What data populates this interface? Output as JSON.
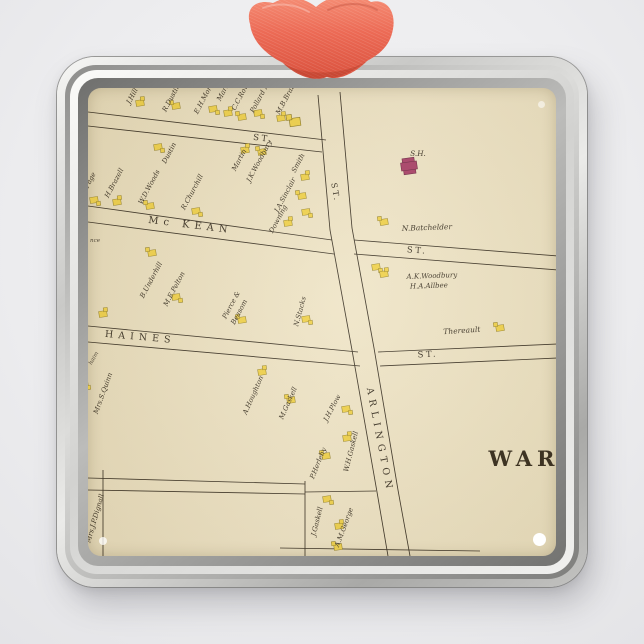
{
  "scene": {
    "description": "square silver metal photo ornament with coral ribbon showing antique street atlas map",
    "ribbon_color": "#ec6a55",
    "ribbon_highlight": "#f69078",
    "ribbon_shadow": "#d34e3a",
    "frame_silver_light": "#f0f0ee",
    "frame_silver_dark": "#8d8d8b",
    "map_background": "#ebe1c3",
    "map_ink": "#3a3226",
    "house_fill": "#f0d24d",
    "house_stroke": "#8d7b25",
    "school_fill": "#a84069"
  },
  "map": {
    "labels": [
      {
        "text": "ST.",
        "kind": "street",
        "x": 263,
        "y": 141,
        "rot": 7
      },
      {
        "text": "ST.",
        "kind": "street",
        "x": 333,
        "y": 193,
        "rot": 80,
        "size": 8
      },
      {
        "text": "Mc KEAN",
        "kind": "street",
        "x": 190,
        "y": 228,
        "rot": 7,
        "ls": 5,
        "size": 10
      },
      {
        "text": "HAINES",
        "kind": "street",
        "x": 140,
        "y": 340,
        "rot": 5,
        "ls": 5,
        "size": 9.5
      },
      {
        "text": "ST.",
        "kind": "street",
        "x": 417,
        "y": 253,
        "rot": 4
      },
      {
        "text": "ST.",
        "kind": "street",
        "x": 428,
        "y": 357,
        "rot": -3
      },
      {
        "text": "ARLINGTON",
        "kind": "street",
        "x": 377,
        "y": 441,
        "rot": 79,
        "ls": 5,
        "size": 9.5
      },
      {
        "text": "nce",
        "kind": "frag",
        "x": 95,
        "y": 242,
        "rot": 0
      },
      {
        "text": "haim",
        "kind": "frag",
        "x": 95,
        "y": 359,
        "rot": -60
      },
      {
        "text": "J.Hill",
        "kind": "name",
        "x": 134,
        "y": 97,
        "rot": -62
      },
      {
        "text": "R.Dustin",
        "kind": "name",
        "x": 173,
        "y": 99,
        "rot": -62
      },
      {
        "text": "E.H.Morrill",
        "kind": "name",
        "x": 207,
        "y": 97,
        "rot": -62
      },
      {
        "text": "Martin",
        "kind": "name",
        "x": 226,
        "y": 91,
        "rot": -62
      },
      {
        "text": "C.C.Rowe",
        "kind": "name",
        "x": 243,
        "y": 96,
        "rot": -62
      },
      {
        "text": "Pollard Mills",
        "kind": "name",
        "x": 264,
        "y": 94,
        "rot": -62
      },
      {
        "text": "M.B.Brazell",
        "kind": "name",
        "x": 289,
        "y": 97,
        "rot": -62
      },
      {
        "text": "J.Page",
        "kind": "name",
        "x": 91,
        "y": 183,
        "rot": -62
      },
      {
        "text": "H.Brazell",
        "kind": "name",
        "x": 116,
        "y": 184,
        "rot": -62
      },
      {
        "text": "W.D.Woods",
        "kind": "name",
        "x": 151,
        "y": 188,
        "rot": -62
      },
      {
        "text": "Dustin",
        "kind": "name",
        "x": 171,
        "y": 154,
        "rot": -62
      },
      {
        "text": "R.Churchill",
        "kind": "name",
        "x": 194,
        "y": 193,
        "rot": -62
      },
      {
        "text": "Martin",
        "kind": "name",
        "x": 241,
        "y": 161,
        "rot": -62
      },
      {
        "text": "J.K.Woodbury",
        "kind": "name",
        "x": 261,
        "y": 162,
        "rot": -62
      },
      {
        "text": "J.A.Sinclair",
        "kind": "name",
        "x": 287,
        "y": 196,
        "rot": -62
      },
      {
        "text": "Smith",
        "kind": "name",
        "x": 300,
        "y": 164,
        "rot": -62
      },
      {
        "text": "Downing",
        "kind": "name",
        "x": 280,
        "y": 220,
        "rot": -62
      },
      {
        "text": "B.Underhill",
        "kind": "name",
        "x": 153,
        "y": 281,
        "rot": -62
      },
      {
        "text": "M.E.Pelton",
        "kind": "name",
        "x": 176,
        "y": 290,
        "rot": -62
      },
      {
        "text": "Pierce &",
        "kind": "name",
        "x": 233,
        "y": 306,
        "rot": -62
      },
      {
        "text": "Beasom",
        "kind": "name",
        "x": 241,
        "y": 313,
        "rot": -62
      },
      {
        "text": "N.Stacks",
        "kind": "name",
        "x": 302,
        "y": 312,
        "rot": -75
      },
      {
        "text": "N.Batchelder",
        "kind": "name",
        "x": 427,
        "y": 230,
        "rot": -2,
        "size": 7.5
      },
      {
        "text": "A.K.Woodbury",
        "kind": "name",
        "x": 432,
        "y": 278,
        "rot": -2,
        "size": 7
      },
      {
        "text": "H.A.Allbee",
        "kind": "name",
        "x": 429,
        "y": 288,
        "rot": -2,
        "size": 7
      },
      {
        "text": "S.H.",
        "kind": "building",
        "x": 418,
        "y": 156,
        "rot": 0
      },
      {
        "text": "Thereault",
        "kind": "name",
        "x": 462,
        "y": 333,
        "rot": -4,
        "size": 7.5
      },
      {
        "text": "Mrs.S.Quinn",
        "kind": "name",
        "x": 105,
        "y": 394,
        "rot": -70
      },
      {
        "text": "A.Houghton",
        "kind": "name",
        "x": 255,
        "y": 396,
        "rot": -66
      },
      {
        "text": "M.Gaskell",
        "kind": "name",
        "x": 290,
        "y": 404,
        "rot": -66
      },
      {
        "text": "J.H.Plow",
        "kind": "name",
        "x": 334,
        "y": 409,
        "rot": -62
      },
      {
        "text": "P.Herlehy",
        "kind": "name",
        "x": 320,
        "y": 464,
        "rot": -68
      },
      {
        "text": "W.H.Gaskell",
        "kind": "name",
        "x": 353,
        "y": 452,
        "rot": -76
      },
      {
        "text": "Mrs.J.P.Dignall",
        "kind": "name",
        "x": 97,
        "y": 519,
        "rot": -74
      },
      {
        "text": "J.Gaskell",
        "kind": "name",
        "x": 319,
        "y": 522,
        "rot": -76
      },
      {
        "text": "A.M.George",
        "kind": "name",
        "x": 346,
        "y": 528,
        "rot": -70
      },
      {
        "text": "WAR",
        "kind": "ward",
        "x": 524,
        "y": 466,
        "rot": 0
      }
    ],
    "houses": [
      {
        "x": 140,
        "y": 103
      },
      {
        "x": 176,
        "y": 106
      },
      {
        "x": 213,
        "y": 109
      },
      {
        "x": 228,
        "y": 113
      },
      {
        "x": 242,
        "y": 117
      },
      {
        "x": 258,
        "y": 113
      },
      {
        "x": 281,
        "y": 118
      },
      {
        "x": 295,
        "y": 122,
        "big": true
      },
      {
        "x": 158,
        "y": 147
      },
      {
        "x": 245,
        "y": 150
      },
      {
        "x": 262,
        "y": 152
      },
      {
        "x": 94,
        "y": 200
      },
      {
        "x": 117,
        "y": 202
      },
      {
        "x": 150,
        "y": 206
      },
      {
        "x": 196,
        "y": 211
      },
      {
        "x": 305,
        "y": 177
      },
      {
        "x": 302,
        "y": 196
      },
      {
        "x": 306,
        "y": 212
      },
      {
        "x": 288,
        "y": 223
      },
      {
        "x": 152,
        "y": 253
      },
      {
        "x": 176,
        "y": 297
      },
      {
        "x": 103,
        "y": 314
      },
      {
        "x": 242,
        "y": 320
      },
      {
        "x": 306,
        "y": 319
      },
      {
        "x": 409,
        "y": 166,
        "kind": "school"
      },
      {
        "x": 384,
        "y": 222
      },
      {
        "x": 376,
        "y": 267
      },
      {
        "x": 384,
        "y": 274
      },
      {
        "x": 500,
        "y": 328
      },
      {
        "x": 84,
        "y": 384
      },
      {
        "x": 262,
        "y": 372
      },
      {
        "x": 291,
        "y": 400
      },
      {
        "x": 346,
        "y": 409
      },
      {
        "x": 347,
        "y": 438
      },
      {
        "x": 326,
        "y": 456
      },
      {
        "x": 327,
        "y": 499
      },
      {
        "x": 339,
        "y": 526
      },
      {
        "x": 338,
        "y": 547
      }
    ]
  }
}
